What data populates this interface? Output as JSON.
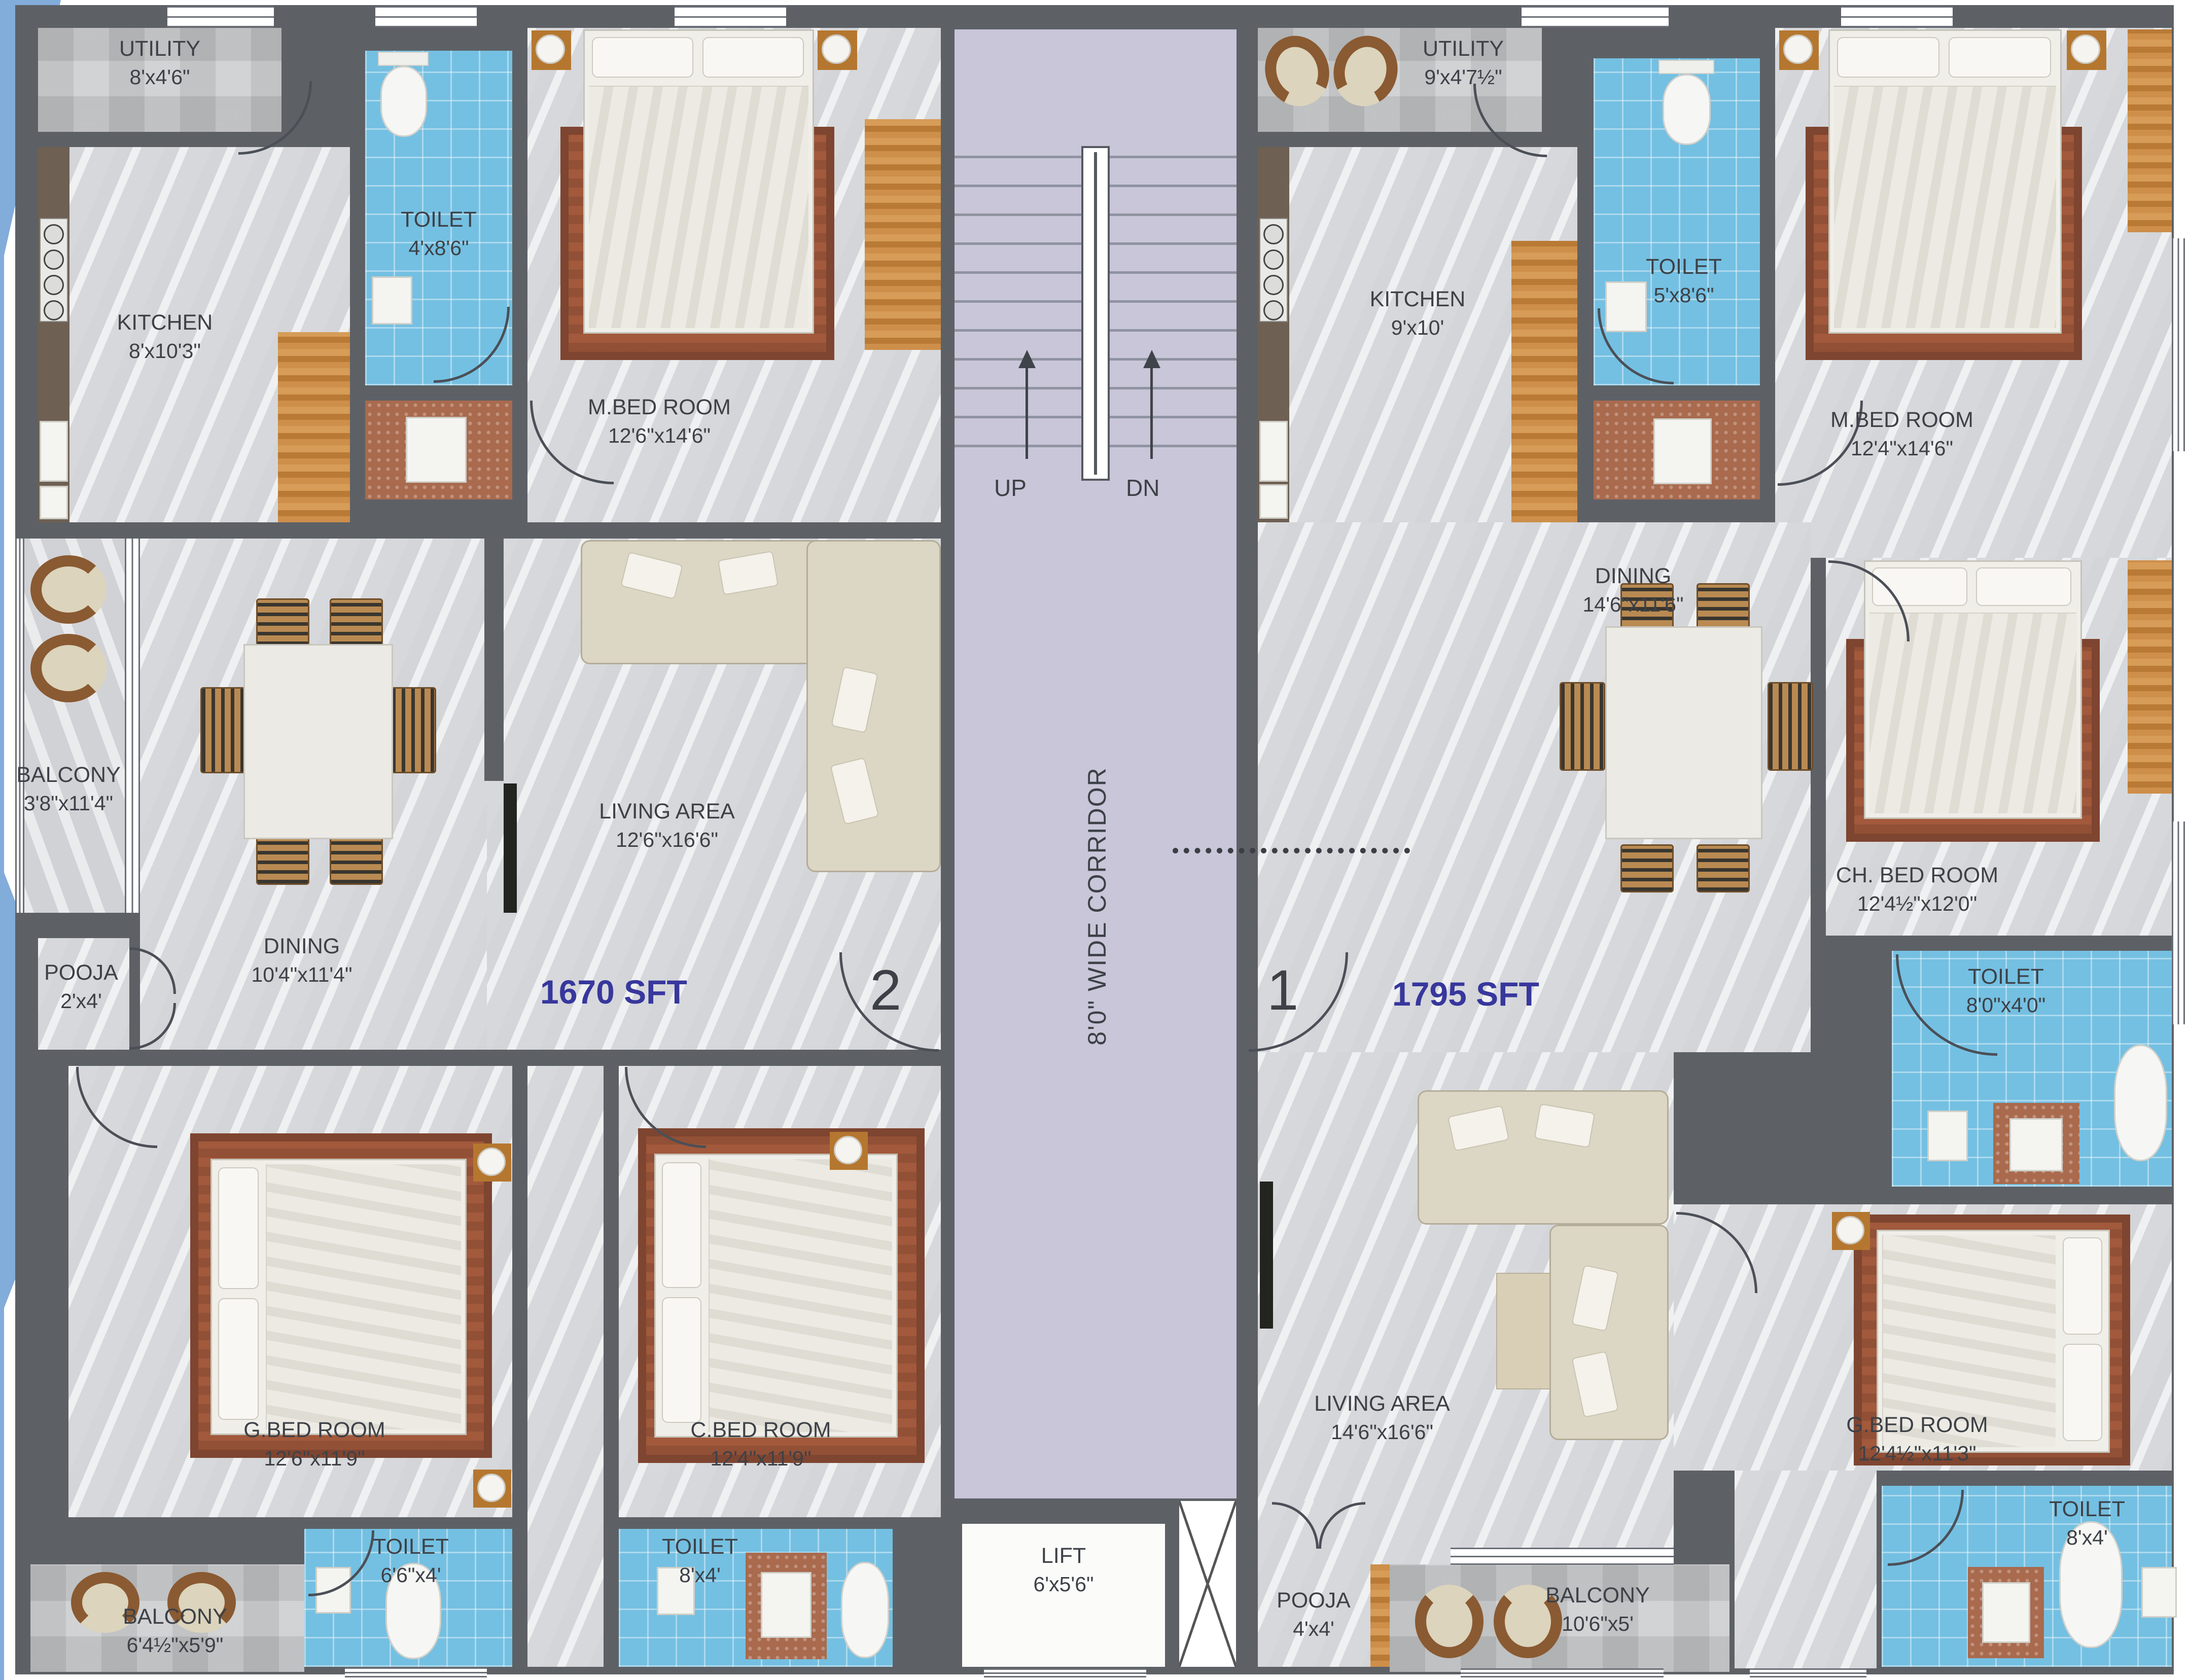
{
  "colors": {
    "wall": "#5d6166",
    "toilet_tile": "#74c0e2",
    "corridor": "#c8c6d8",
    "area_text": "#37379d",
    "label_text": "#3d4147",
    "wood": "#b97a35",
    "accent_triangle": "#82acda"
  },
  "core": {
    "up": "UP",
    "dn": "DN",
    "corridor_label": "8'0\" WIDE CORRIDOR",
    "lift": {
      "name": "LIFT",
      "dim": "6'x5'6\""
    }
  },
  "unit2": {
    "door_number": "2",
    "area_label": "1670 SFT",
    "rooms": {
      "utility": {
        "name": "UTILITY",
        "dim": "8'x4'6\""
      },
      "toilet_top": {
        "name": "TOILET",
        "dim": "4'x8'6\""
      },
      "kitchen": {
        "name": "KITCHEN",
        "dim": "8'x10'3\""
      },
      "master_bedroom": {
        "name": "M.BED ROOM",
        "dim": "12'6\"x14'6\""
      },
      "balcony_side": {
        "name": "BALCONY",
        "dim": "3'8\"x11'4\""
      },
      "dining": {
        "name": "DINING",
        "dim": "10'4\"x11'4\""
      },
      "living": {
        "name": "LIVING AREA",
        "dim": "12'6\"x16'6\""
      },
      "pooja": {
        "name": "POOJA",
        "dim": "2'x4'"
      },
      "guest_bedroom": {
        "name": "G.BED ROOM",
        "dim": "12'6\"x11'9\""
      },
      "child_bedroom": {
        "name": "C.BED ROOM",
        "dim": "12'4\"x11'9\""
      },
      "toilet_g": {
        "name": "TOILET",
        "dim": "6'6\"x4'"
      },
      "toilet_c": {
        "name": "TOILET",
        "dim": "8'x4'"
      },
      "balcony_bottom": {
        "name": "BALCONY",
        "dim": "6'4½\"x5'9\""
      }
    }
  },
  "unit1": {
    "door_number": "1",
    "area_label": "1795 SFT",
    "rooms": {
      "utility": {
        "name": "UTILITY",
        "dim": "9'x4'7½\""
      },
      "toilet_top": {
        "name": "TOILET",
        "dim": "5'x8'6\""
      },
      "kitchen": {
        "name": "KITCHEN",
        "dim": "9'x10'"
      },
      "master_bedroom": {
        "name": "M.BED ROOM",
        "dim": "12'4\"x14'6\""
      },
      "dining": {
        "name": "DINING",
        "dim": "14'6\"x11'6\""
      },
      "child_bedroom": {
        "name": "CH. BED ROOM",
        "dim": "12'4½\"x12'0\""
      },
      "toilet_ch": {
        "name": "TOILET",
        "dim": "8'0\"x4'0\""
      },
      "living": {
        "name": "LIVING AREA",
        "dim": "14'6\"x16'6\""
      },
      "guest_bedroom": {
        "name": "G.BED ROOM",
        "dim": "12'4½\"x11'3\""
      },
      "toilet_g": {
        "name": "TOILET",
        "dim": "8'x4'"
      },
      "pooja": {
        "name": "POOJA",
        "dim": "4'x4'"
      },
      "balcony_bottom": {
        "name": "BALCONY",
        "dim": "10'6\"x5'"
      }
    }
  }
}
